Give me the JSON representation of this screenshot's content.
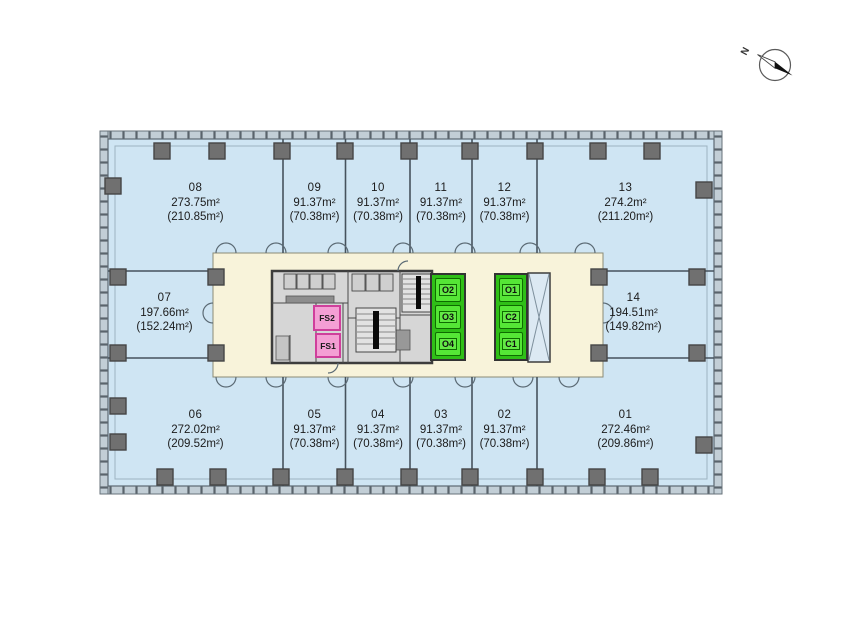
{
  "compass": {
    "label": "N"
  },
  "units": [
    {
      "id": "08",
      "area": "273.75m²",
      "net": "(210.85m²)"
    },
    {
      "id": "09",
      "area": "91.37m²",
      "net": "(70.38m²)"
    },
    {
      "id": "10",
      "area": "91.37m²",
      "net": "(70.38m²)"
    },
    {
      "id": "11",
      "area": "91.37m²",
      "net": "(70.38m²)"
    },
    {
      "id": "12",
      "area": "91.37m²",
      "net": "(70.38m²)"
    },
    {
      "id": "13",
      "area": "274.2m²",
      "net": "(211.20m²)"
    },
    {
      "id": "07",
      "area": "197.66m²",
      "net": "(152.24m²)"
    },
    {
      "id": "14",
      "area": "194.51m²",
      "net": "(149.82m²)"
    },
    {
      "id": "06",
      "area": "272.02m²",
      "net": "(209.52m²)"
    },
    {
      "id": "05",
      "area": "91.37m²",
      "net": "(70.38m²)"
    },
    {
      "id": "04",
      "area": "91.37m²",
      "net": "(70.38m²)"
    },
    {
      "id": "03",
      "area": "91.37m²",
      "net": "(70.38m²)"
    },
    {
      "id": "02",
      "area": "91.37m²",
      "net": "(70.38m²)"
    },
    {
      "id": "01",
      "area": "272.46m²",
      "net": "(209.86m²)"
    }
  ],
  "core": {
    "bank_left": {
      "cells": [
        "O2",
        "O3",
        "O4"
      ]
    },
    "bank_right": {
      "cells": [
        "O1",
        "C2",
        "C1"
      ]
    },
    "fire_stairs": {
      "cells": [
        "FS2",
        "FS1"
      ]
    }
  },
  "colors": {
    "floor_blue": "#cfe5f3",
    "corridor_cream": "#f8f3da",
    "core_gray": "#d6d6d6",
    "elevator_green": "#55e636",
    "stair_pink": "#f49fd4",
    "facade_band": "#c2ced6",
    "column_gray": "#707070"
  }
}
